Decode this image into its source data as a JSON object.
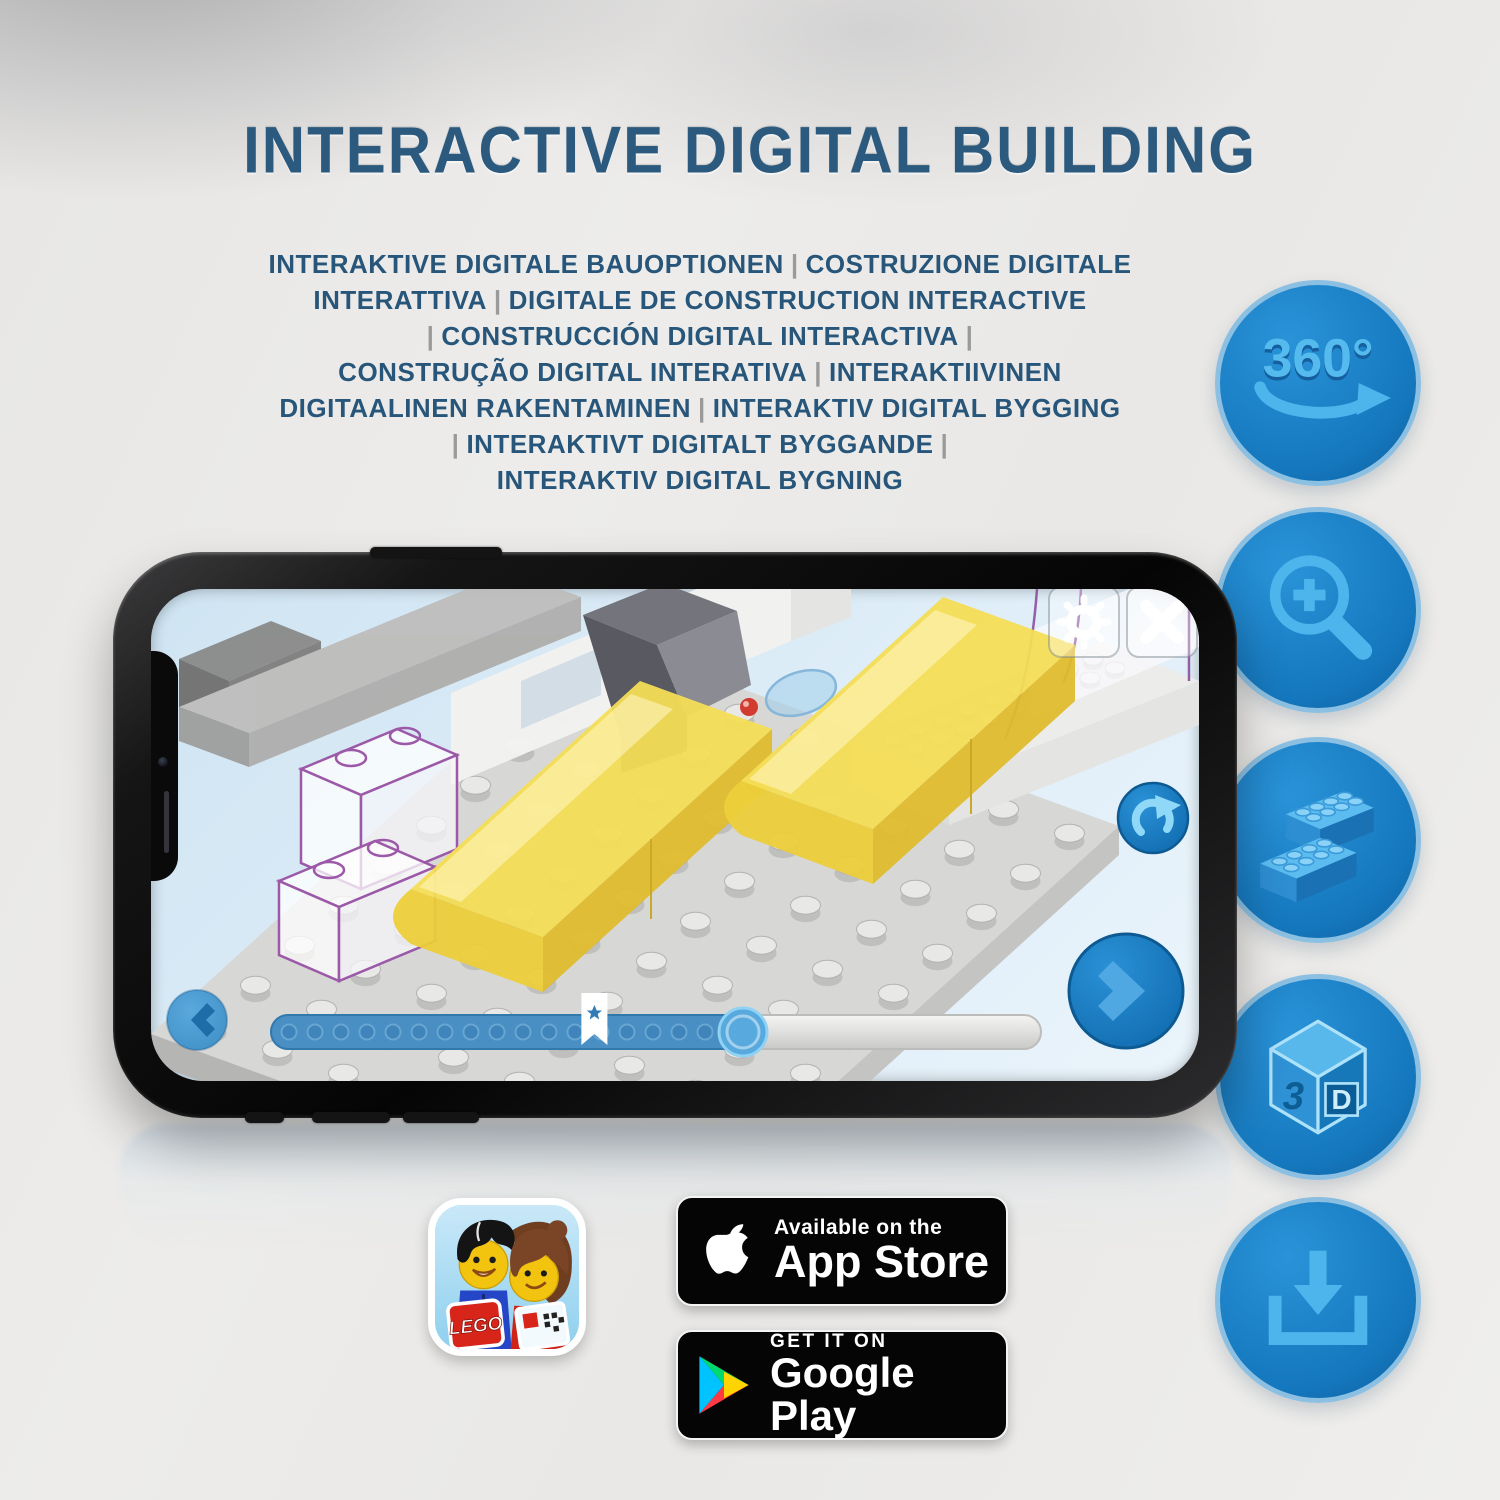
{
  "title": "INTERACTIVE DIGITAL BUILDING",
  "subtitle_lines": [
    "INTERAKTIVE DIGITALE BAUOPTIONEN | COSTRUZIONE DIGITALE",
    "INTERATTIVA | DIGITALE DE CONSTRUCTION INTERACTIVE",
    "| CONSTRUCCIÓN DIGITAL INTERACTIVA |",
    "CONSTRUÇÃO DIGITAL INTERATIVA | INTERAKTIIVINEN",
    "DIGITAALINEN RAKENTAMINEN | INTERAKTIV DIGITAL BYGGING",
    "| INTERAKTIVT DIGITALT BYGGANDE |",
    "INTERAKTIV DIGITAL BYGNING"
  ],
  "phone": {
    "screen": {
      "slider": {
        "dots": 17,
        "bookmark_ratio": 0.42,
        "handle_ratio": 0.613
      }
    }
  },
  "feature_icons": [
    {
      "id": "rotate-360",
      "label": "360°"
    },
    {
      "id": "zoom-in"
    },
    {
      "id": "bricks"
    },
    {
      "id": "view-3d",
      "letters": [
        "3",
        "D"
      ]
    },
    {
      "id": "download"
    }
  ],
  "app_badges": {
    "lego_app": {
      "logo_text": "LEGO"
    },
    "app_store": {
      "line1": "Available on the",
      "line2": "App Store"
    },
    "google_play": {
      "line1": "GET IT ON",
      "line2": "Google Play"
    }
  },
  "colors": {
    "accent_blue": "#1578be",
    "icon_glyph_blue": "#4db4ec",
    "title_blue": "#2b5a7e",
    "lego_yellow": "#f4dd55",
    "ghost_outline_purple": "#9b59a8",
    "badge_black": "#050505"
  }
}
